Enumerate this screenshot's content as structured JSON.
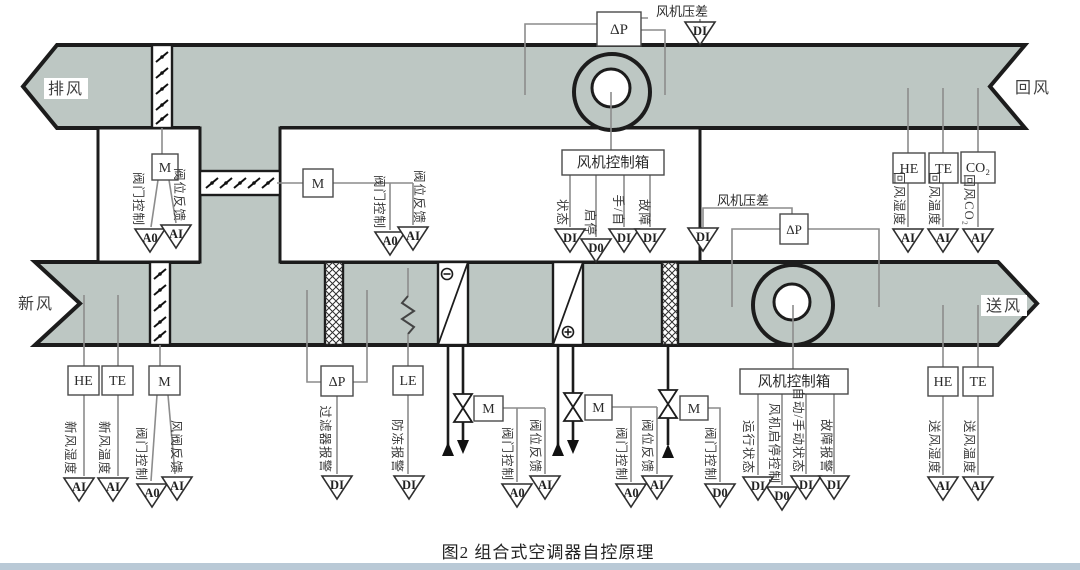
{
  "caption": "图2    组合式空调器自控原理",
  "duct_labels": {
    "exhaust": "排风",
    "return": "回风",
    "fresh": "新风",
    "supply": "送风"
  },
  "equipment": {
    "motor": "M",
    "dp": "ΔP",
    "le": "LE",
    "he": "HE",
    "te": "TE",
    "co2": "CO₂",
    "fan_control_box": "风机控制箱",
    "fan_dp": "风机压差"
  },
  "io_points": {
    "ai": "AI",
    "ao": "A0",
    "di": "DI",
    "do": "D0"
  },
  "signals": {
    "valve_control": "阀门控制",
    "valve_position_fb": "阀位反馈",
    "damper_fb": "风阀反馈",
    "fresh_humidity": "新风湿度",
    "fresh_temp": "新风温度",
    "filter_alarm": "过滤器报警",
    "frost_alarm": "防冻报警",
    "status": "状态",
    "start_stop": "启停",
    "hand_auto": "手/自",
    "fault": "故障",
    "run_status": "运行状态",
    "fan_start_stop_ctrl": "风机启停控制",
    "auto_manual_status": "自动/手动状态",
    "fault_alarm": "故障报警",
    "return_humidity": "回风湿度",
    "return_temp": "回风温度",
    "return_co2": "回风CO₂",
    "supply_humidity": "送风湿度",
    "supply_temp": "送风温度"
  },
  "colors": {
    "duct_fill": "#bdc7c3",
    "outline": "#1c1c1c",
    "wire": "#8c8c8c",
    "footer_bar": "#b9c9d6"
  }
}
